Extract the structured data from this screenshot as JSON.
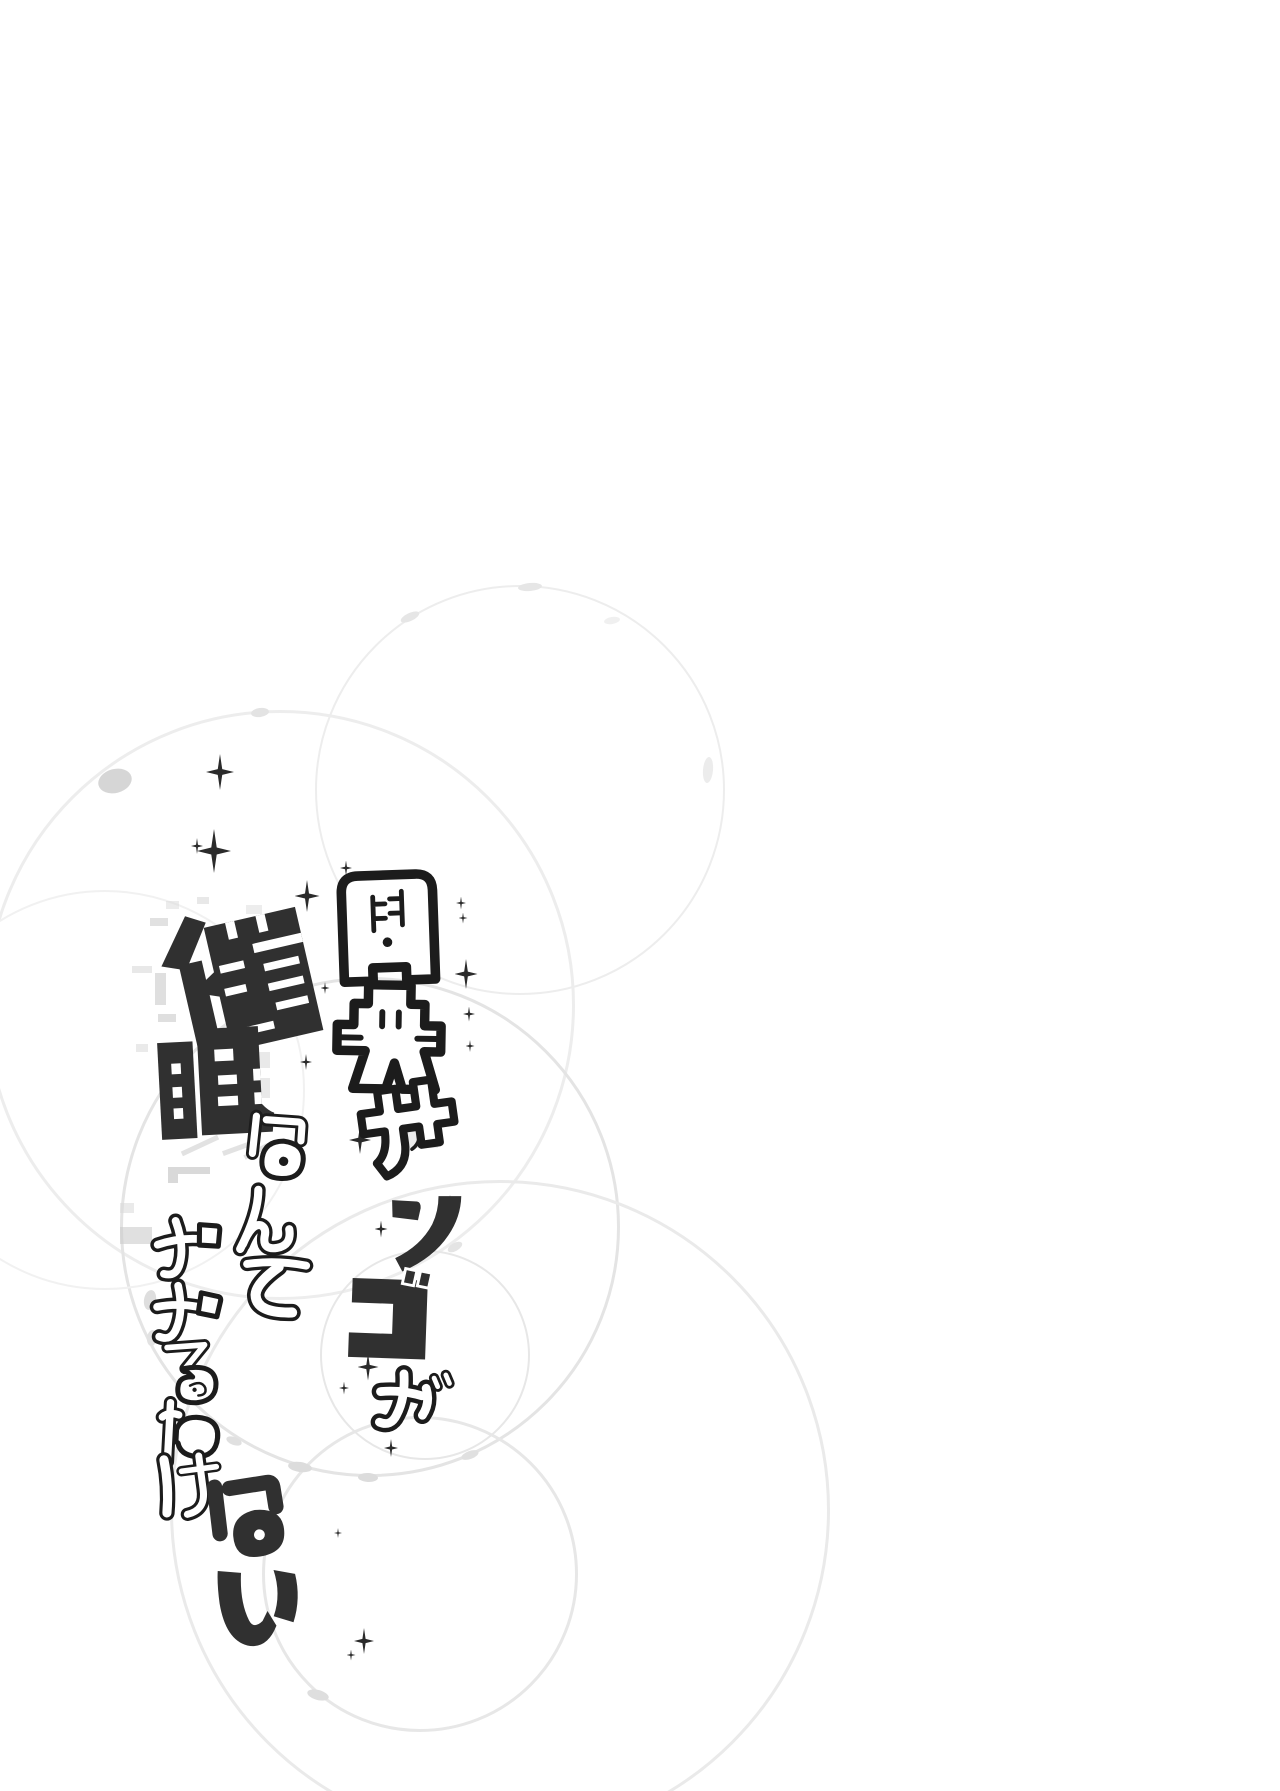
{
  "page": {
    "kind": "doujinshi-title-page",
    "background_color": "#ffffff",
    "width_px": 1280,
    "height_px": 1791
  },
  "title": {
    "text": "周央サンゴが催眠なんてかかるわけない",
    "right_column": {
      "text": "周央サンゴが",
      "chars": [
        "周",
        "央",
        "サ",
        "ン",
        "ゴ",
        "が"
      ]
    },
    "left_column": {
      "text": "催眠なんてかかるわけない",
      "chars": [
        "催",
        "眠",
        "な",
        "ん",
        "て",
        "か",
        "か",
        "る",
        "わ",
        "け",
        "な",
        "い"
      ]
    }
  },
  "colors": {
    "ink_solid": "#303030",
    "outline": "#1c1c1c",
    "glyph_fill": "#ffffff",
    "sparkle": "#2b2b2b",
    "ring_faint": "#ececec",
    "glitch_gray": "#c9c9c9"
  },
  "decor": {
    "rings": [
      {
        "cx": 520,
        "cy": 790,
        "r": 205,
        "w": 2,
        "c": "#ededed"
      },
      {
        "cx": 280,
        "cy": 1005,
        "r": 295,
        "w": 3,
        "c": "#ededed"
      },
      {
        "cx": 370,
        "cy": 1227,
        "r": 250,
        "w": 3,
        "c": "#e4e4e4"
      },
      {
        "cx": 420,
        "cy": 1574,
        "r": 158,
        "w": 3,
        "c": "#e7e7e7"
      },
      {
        "cx": 425,
        "cy": 1355,
        "r": 105,
        "w": 2,
        "c": "#e7e7e7"
      },
      {
        "cx": 105,
        "cy": 1090,
        "r": 200,
        "w": 2,
        "c": "#f1f1f1"
      },
      {
        "cx": 500,
        "cy": 1510,
        "r": 330,
        "w": 3,
        "c": "#eaeaea"
      }
    ],
    "beads": [
      {
        "x": 115,
        "y": 781,
        "w": 34,
        "h": 24,
        "rot": -15,
        "c": "#d6d6d6"
      },
      {
        "x": 260,
        "y": 712,
        "w": 18,
        "h": 9,
        "rot": -8,
        "c": "#e3e3e3"
      },
      {
        "x": 410,
        "y": 617,
        "w": 20,
        "h": 8,
        "rot": -25,
        "c": "#e6e6e6"
      },
      {
        "x": 530,
        "y": 587,
        "w": 24,
        "h": 8,
        "rot": -5,
        "c": "#e6e6e6"
      },
      {
        "x": 300,
        "y": 1467,
        "w": 24,
        "h": 10,
        "rot": 8,
        "c": "#dcdcdc"
      },
      {
        "x": 368,
        "y": 1477,
        "w": 20,
        "h": 9,
        "rot": 3,
        "c": "#dcdcdc"
      },
      {
        "x": 234,
        "y": 1441,
        "w": 16,
        "h": 8,
        "rot": 20,
        "c": "#e0e0e0"
      },
      {
        "x": 318,
        "y": 1695,
        "w": 22,
        "h": 10,
        "rot": 15,
        "c": "#dedede"
      },
      {
        "x": 150,
        "y": 1300,
        "w": 12,
        "h": 20,
        "rot": 10,
        "c": "#dedede"
      },
      {
        "x": 152,
        "y": 1338,
        "w": 10,
        "h": 16,
        "rot": 8,
        "c": "#e2e2e2"
      },
      {
        "x": 455,
        "y": 1247,
        "w": 16,
        "h": 8,
        "rot": -30,
        "c": "#e4e4e4"
      },
      {
        "x": 470,
        "y": 1455,
        "w": 18,
        "h": 8,
        "rot": -20,
        "c": "#e0e0e0"
      },
      {
        "x": 708,
        "y": 770,
        "w": 10,
        "h": 26,
        "rot": 5,
        "c": "#ececec"
      },
      {
        "x": 612,
        "y": 620,
        "w": 16,
        "h": 7,
        "rot": -10,
        "c": "#f0f0f0"
      }
    ],
    "glitches": [
      {
        "x": 150,
        "y": 918,
        "w": 18,
        "h": 8,
        "c": "#c9c9c9",
        "o": 0.55,
        "rot": 0
      },
      {
        "x": 155,
        "y": 973,
        "w": 11,
        "h": 32,
        "c": "#c9c9c9",
        "o": 0.6,
        "rot": 0
      },
      {
        "x": 132,
        "y": 966,
        "w": 20,
        "h": 7,
        "c": "#d6d6d6",
        "o": 0.55,
        "rot": 0
      },
      {
        "x": 158,
        "y": 1014,
        "w": 18,
        "h": 8,
        "c": "#c9c9c9",
        "o": 0.6,
        "rot": 0
      },
      {
        "x": 197,
        "y": 897,
        "w": 12,
        "h": 7,
        "c": "#d2d2d2",
        "o": 0.5,
        "rot": 0
      },
      {
        "x": 166,
        "y": 901,
        "w": 13,
        "h": 8,
        "c": "#dadada",
        "o": 0.5,
        "rot": 0
      },
      {
        "x": 136,
        "y": 1044,
        "w": 12,
        "h": 8,
        "c": "#d6d6d6",
        "o": 0.5,
        "rot": 0
      },
      {
        "x": 120,
        "y": 1203,
        "w": 14,
        "h": 10,
        "c": "#d8d8d8",
        "o": 0.55,
        "rot": 0
      },
      {
        "x": 120,
        "y": 1227,
        "w": 32,
        "h": 17,
        "c": "#cccccc",
        "o": 0.6,
        "rot": 0
      },
      {
        "x": 168,
        "y": 1167,
        "w": 42,
        "h": 7,
        "c": "#c4c4c4",
        "o": 0.65,
        "rot": 0
      },
      {
        "x": 168,
        "y": 1174,
        "w": 10,
        "h": 9,
        "c": "#c4c4c4",
        "o": 0.65,
        "rot": 0
      },
      {
        "x": 408,
        "y": 1122,
        "w": 30,
        "h": 26,
        "c": "#d9d9d9",
        "o": 0.5,
        "rot": 0
      },
      {
        "x": 256,
        "y": 1052,
        "w": 14,
        "h": 16,
        "c": "#d4d4d4",
        "o": 0.5,
        "rot": 0
      },
      {
        "x": 258,
        "y": 1078,
        "w": 12,
        "h": 20,
        "c": "#d4d4d4",
        "o": 0.5,
        "rot": 0
      },
      {
        "x": 246,
        "y": 905,
        "w": 16,
        "h": 9,
        "c": "#dbdbdb",
        "o": 0.5,
        "rot": 0
      },
      {
        "x": 252,
        "y": 922,
        "w": 10,
        "h": 8,
        "c": "#dbdbdb",
        "o": 0.5,
        "rot": 0
      },
      {
        "x": 180,
        "y": 1143,
        "w": 40,
        "h": 5,
        "c": "#cfcfcf",
        "o": 0.6,
        "rot": -25
      },
      {
        "x": 222,
        "y": 1146,
        "w": 30,
        "h": 5,
        "c": "#cfcfcf",
        "o": 0.6,
        "rot": -20
      },
      {
        "x": 243,
        "y": 1149,
        "w": 26,
        "h": 5,
        "c": "#cfcfcf",
        "o": 0.6,
        "rot": -28
      }
    ],
    "sparkles": [
      {
        "x": 220,
        "y": 772,
        "s": 36
      },
      {
        "x": 214,
        "y": 851,
        "s": 44
      },
      {
        "x": 197,
        "y": 846,
        "s": 16
      },
      {
        "x": 307,
        "y": 896,
        "s": 32
      },
      {
        "x": 346,
        "y": 868,
        "s": 15
      },
      {
        "x": 461,
        "y": 903,
        "s": 13
      },
      {
        "x": 463,
        "y": 918,
        "s": 11
      },
      {
        "x": 466,
        "y": 974,
        "s": 30
      },
      {
        "x": 469,
        "y": 1014,
        "s": 15
      },
      {
        "x": 470,
        "y": 1046,
        "s": 12
      },
      {
        "x": 306,
        "y": 1062,
        "s": 16
      },
      {
        "x": 325,
        "y": 988,
        "s": 12
      },
      {
        "x": 360,
        "y": 1140,
        "s": 28
      },
      {
        "x": 450,
        "y": 1202,
        "s": 14
      },
      {
        "x": 381,
        "y": 1229,
        "s": 17
      },
      {
        "x": 368,
        "y": 1367,
        "s": 27
      },
      {
        "x": 344,
        "y": 1388,
        "s": 13
      },
      {
        "x": 381,
        "y": 1392,
        "s": 11
      },
      {
        "x": 391,
        "y": 1448,
        "s": 18
      },
      {
        "x": 338,
        "y": 1533,
        "s": 10
      },
      {
        "x": 364,
        "y": 1641,
        "s": 26
      },
      {
        "x": 351,
        "y": 1655,
        "s": 11
      }
    ]
  }
}
